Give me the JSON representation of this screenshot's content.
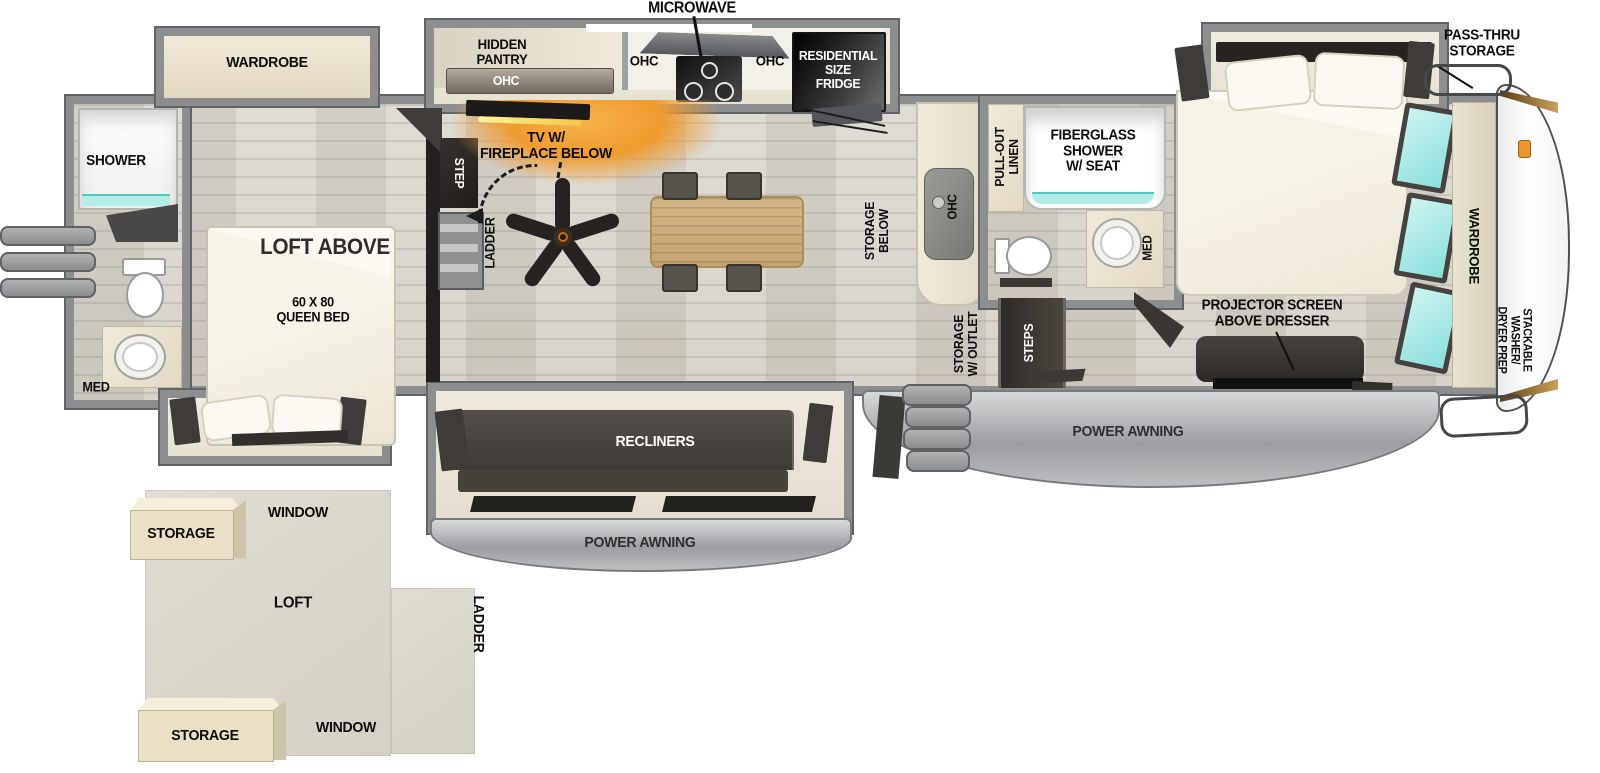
{
  "colors": {
    "wall_gray": "#8c8e90",
    "floor_wood": "#d8d4cb",
    "cabinet_cream": "#e9e2d1",
    "dark_fixture": "#2e2b28",
    "window_cyan": "#9fe9e7",
    "fireplace_orange": "#f2a23a",
    "awning_gray": "#b9bbbd",
    "table_wood": "#c9ab74"
  },
  "exterior": {
    "pass_thru_storage": "PASS-THRU\nSTORAGE",
    "power_awning_main": "POWER AWNING",
    "power_awning_recliner": "POWER AWNING"
  },
  "rear_bath": {
    "shower": "SHOWER",
    "med": "MED"
  },
  "rear_bedroom": {
    "wardrobe": "WARDROBE",
    "loft_above": "LOFT ABOVE",
    "queen_bed": "60 X 80\nQUEEN BED",
    "step": "STEP",
    "ladder": "LADDER"
  },
  "kitchen": {
    "microwave": "MICROWAVE",
    "hidden_pantry": "HIDDEN\nPANTRY",
    "ohc_pantry": "OHC",
    "ohc_left": "OHC",
    "ohc_right": "OHC",
    "fridge": "RESIDENTIAL\nSIZE\nFRIDGE",
    "ohc_sink": "OHC",
    "storage_below": "STORAGE\nBELOW"
  },
  "living": {
    "tv_fireplace": "TV W/\nFIREPLACE BELOW",
    "recliners": "RECLINERS"
  },
  "mid_bath": {
    "pull_out_linen": "PULL-OUT\nLINEN",
    "fiberglass_shower": "FIBERGLASS\nSHOWER\nW/ SEAT",
    "med": "MED"
  },
  "entry": {
    "storage_outlet": "STORAGE\nW/ OUTLET",
    "steps": "STEPS"
  },
  "front_bedroom": {
    "projector": "PROJECTOR SCREEN\nABOVE DRESSER",
    "wardrobe": "WARDROBE",
    "washer_dryer": "STACKABLE WASHER/\nDRYER PREP"
  },
  "loft_diagram": {
    "loft": "LOFT",
    "ladder": "LADDER",
    "window_top": "WINDOW",
    "window_bottom": "WINDOW",
    "storage_top": "STORAGE",
    "storage_bottom": "STORAGE"
  }
}
